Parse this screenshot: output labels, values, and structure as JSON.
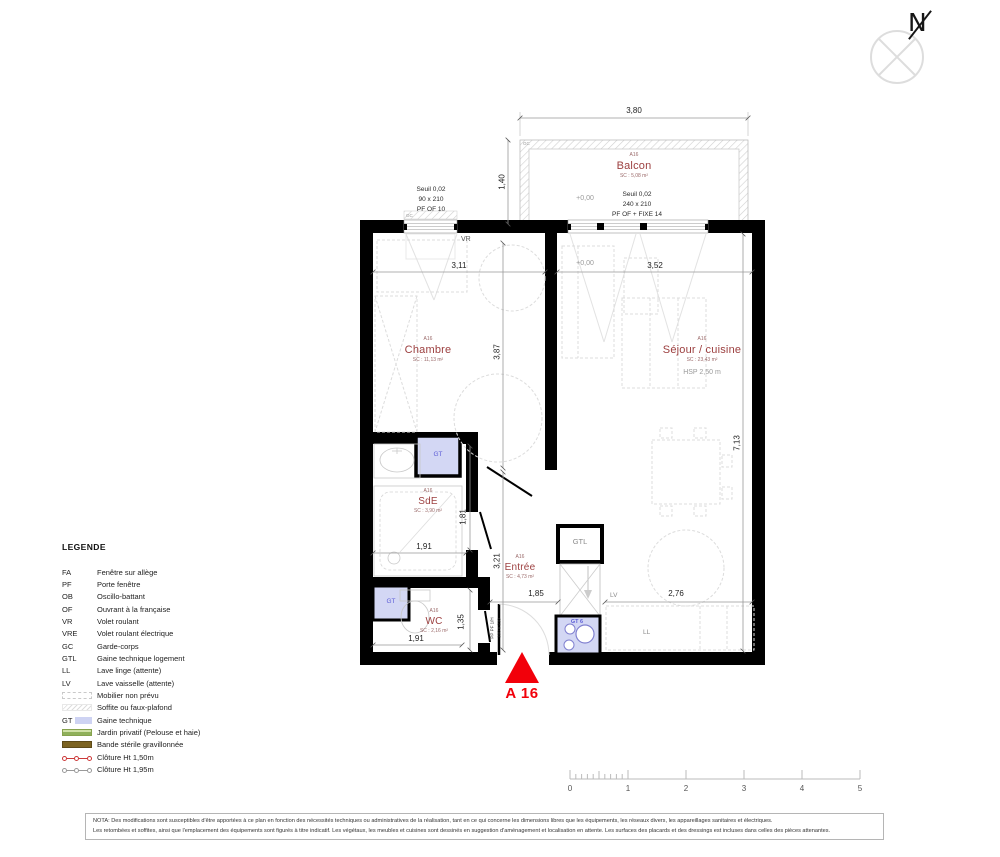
{
  "north": {
    "label": "N"
  },
  "marker": {
    "label": "A 16"
  },
  "rooms": {
    "balcon": {
      "unit": "A16",
      "name": "Balcon",
      "area": "SC : 5,08 m²"
    },
    "chambre": {
      "unit": "A16",
      "name": "Chambre",
      "area": "SC : 11,13 m²"
    },
    "sejour": {
      "unit": "A16",
      "name": "Séjour / cuisine",
      "area": "SC : 23,43 m²",
      "hsp": "HSP 2,50 m"
    },
    "sde": {
      "unit": "A16",
      "name": "SdE",
      "area": "SC : 3,90 m²"
    },
    "wc": {
      "unit": "A16",
      "name": "WC",
      "area": "SC : 2,16 m²"
    },
    "entree": {
      "unit": "A16",
      "name": "Entrée",
      "area": "SC : 4,73 m²"
    }
  },
  "openings": {
    "chambre_window": {
      "l1": "Seuil 0,02",
      "l2": "90 x 210",
      "l3": "PF OF 10"
    },
    "balcon_window": {
      "l1": "Seuil 0,02",
      "l2": "240 x 210",
      "l3": "PF OF + FIXE 14"
    },
    "entry_door": {
      "l1": "PP PF 1/H",
      "l2": "100 x 210"
    }
  },
  "levels": {
    "balcon": "+0,00",
    "sejour": "+0,00"
  },
  "dims": {
    "balcon_w": "3,80",
    "balcon_d": "1,40",
    "chambre_w": "3,11",
    "sejour_w": "3,52",
    "chambre_d": "3,87",
    "side_d": "7,13",
    "sde_w": "1,91",
    "sde_d": "1,81",
    "entree_d": "3,21",
    "entree_w": "1,85",
    "wc_d": "1,35",
    "wc_w": "1,91",
    "cuisine_w": "2,76"
  },
  "tags": {
    "vr": "VR",
    "gc_window": "GC",
    "gc_balcon": "GC",
    "gtl": "GTL",
    "gt_sde": "GT",
    "gt_wc": "GT",
    "gt6": "GT 6",
    "lv": "LV",
    "ll": "LL"
  },
  "legend": {
    "title": "LEGENDE",
    "items": [
      {
        "code": "FA",
        "label": "Fenêtre sur allège"
      },
      {
        "code": "PF",
        "label": "Porte fenêtre"
      },
      {
        "code": "OB",
        "label": "Oscillo-battant"
      },
      {
        "code": "OF",
        "label": "Ouvrant à la française"
      },
      {
        "code": "VR",
        "label": "Volet roulant"
      },
      {
        "code": "VRE",
        "label": "Volet roulant électrique"
      },
      {
        "code": "GC",
        "label": "Garde-corps"
      },
      {
        "code": "GTL",
        "label": "Gaine technique logement"
      },
      {
        "code": "LL",
        "label": "Lave linge (attente)"
      },
      {
        "code": "LV",
        "label": "Lave vaisselle (attente)"
      },
      {
        "code": "",
        "label": "Mobilier non prévu"
      },
      {
        "code": "",
        "label": "Soffite ou faux-plafond"
      },
      {
        "code": "GT",
        "label": "Gaine technique"
      },
      {
        "code": "",
        "label": "Jardin privatif (Pelouse et haie)"
      },
      {
        "code": "",
        "label": "Bande stérile gravillonnée"
      },
      {
        "code": "",
        "label": "Clôture  Ht 1,50m"
      },
      {
        "code": "",
        "label": "Clôture  Ht 1,95m"
      }
    ]
  },
  "scalebar": {
    "labels": [
      "0",
      "1",
      "2",
      "3",
      "4",
      "5"
    ]
  },
  "nota": {
    "line1": "NOTA: Des modifications sont susceptibles d'être apportées à ce plan en fonction des nécessités techniques ou administratives de la réalisation, tant en ce qui concerne les dimensions libres que les équipements, les réseaux divers, les appareillages sanitaires et électriques.",
    "line2": "Les retombées et soffites, ainsi que l'emplacement des équipements sont figurés à titre indicatif. Les végétaux, les meubles et cuisines sont dessinés en suggestion d'aménagement et localisation en attente. Les surfaces des placards et des dressings est incluses dans celles des pièces attenantes."
  },
  "colors": {
    "wall": "#000000",
    "room_label": "#9c3f3f",
    "marker_red": "#f2000a",
    "gt_fill": "#d3d7f4",
    "gt_text": "#5c5cd6",
    "legend_green": "#8fb05a",
    "legend_brown": "#7c6321",
    "cloture_red": "#cc3a3a",
    "cloture_gray": "#9a9a9a"
  }
}
